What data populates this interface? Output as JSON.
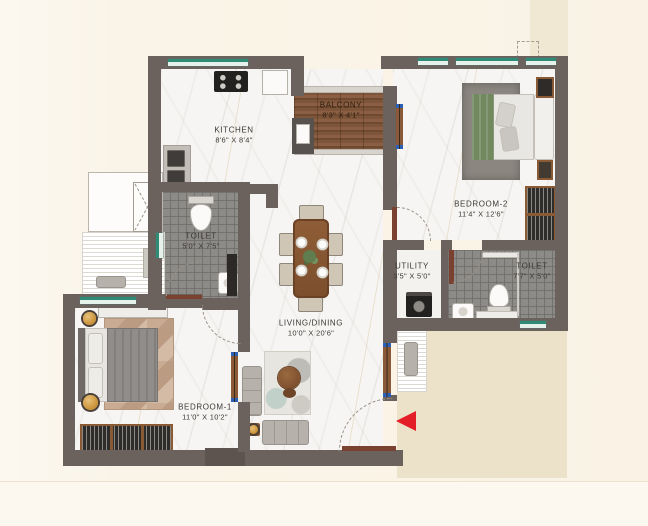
{
  "plan": {
    "rooms": [
      {
        "name": "KITCHEN",
        "dims": "8'6\" X 8'4\""
      },
      {
        "name": "BALCONY",
        "dims": "8'3\" X 4'1\""
      },
      {
        "name": "BEDROOM-2",
        "dims": "11'4\" X 12'6\""
      },
      {
        "name": "TOILET",
        "dims": "5'0\" X 7'5\""
      },
      {
        "name": "UTILITY",
        "dims": "3'5\" X 5'0\""
      },
      {
        "name": "TOILET",
        "dims": "7'7\" X 5'0\""
      },
      {
        "name": "LIVING/DINING",
        "dims": "10'0\" X 20'6\""
      },
      {
        "name": "BEDROOM-1",
        "dims": "11'0\" X 10'2\""
      }
    ],
    "colors": {
      "wall": "#6b615d",
      "window_green": "#2e8b74",
      "tile_gray": "#8d8b88",
      "door_wood": "#7a4030",
      "outside_beige": "#ece2c9",
      "entry_arrow_red": "#e41e26"
    }
  }
}
